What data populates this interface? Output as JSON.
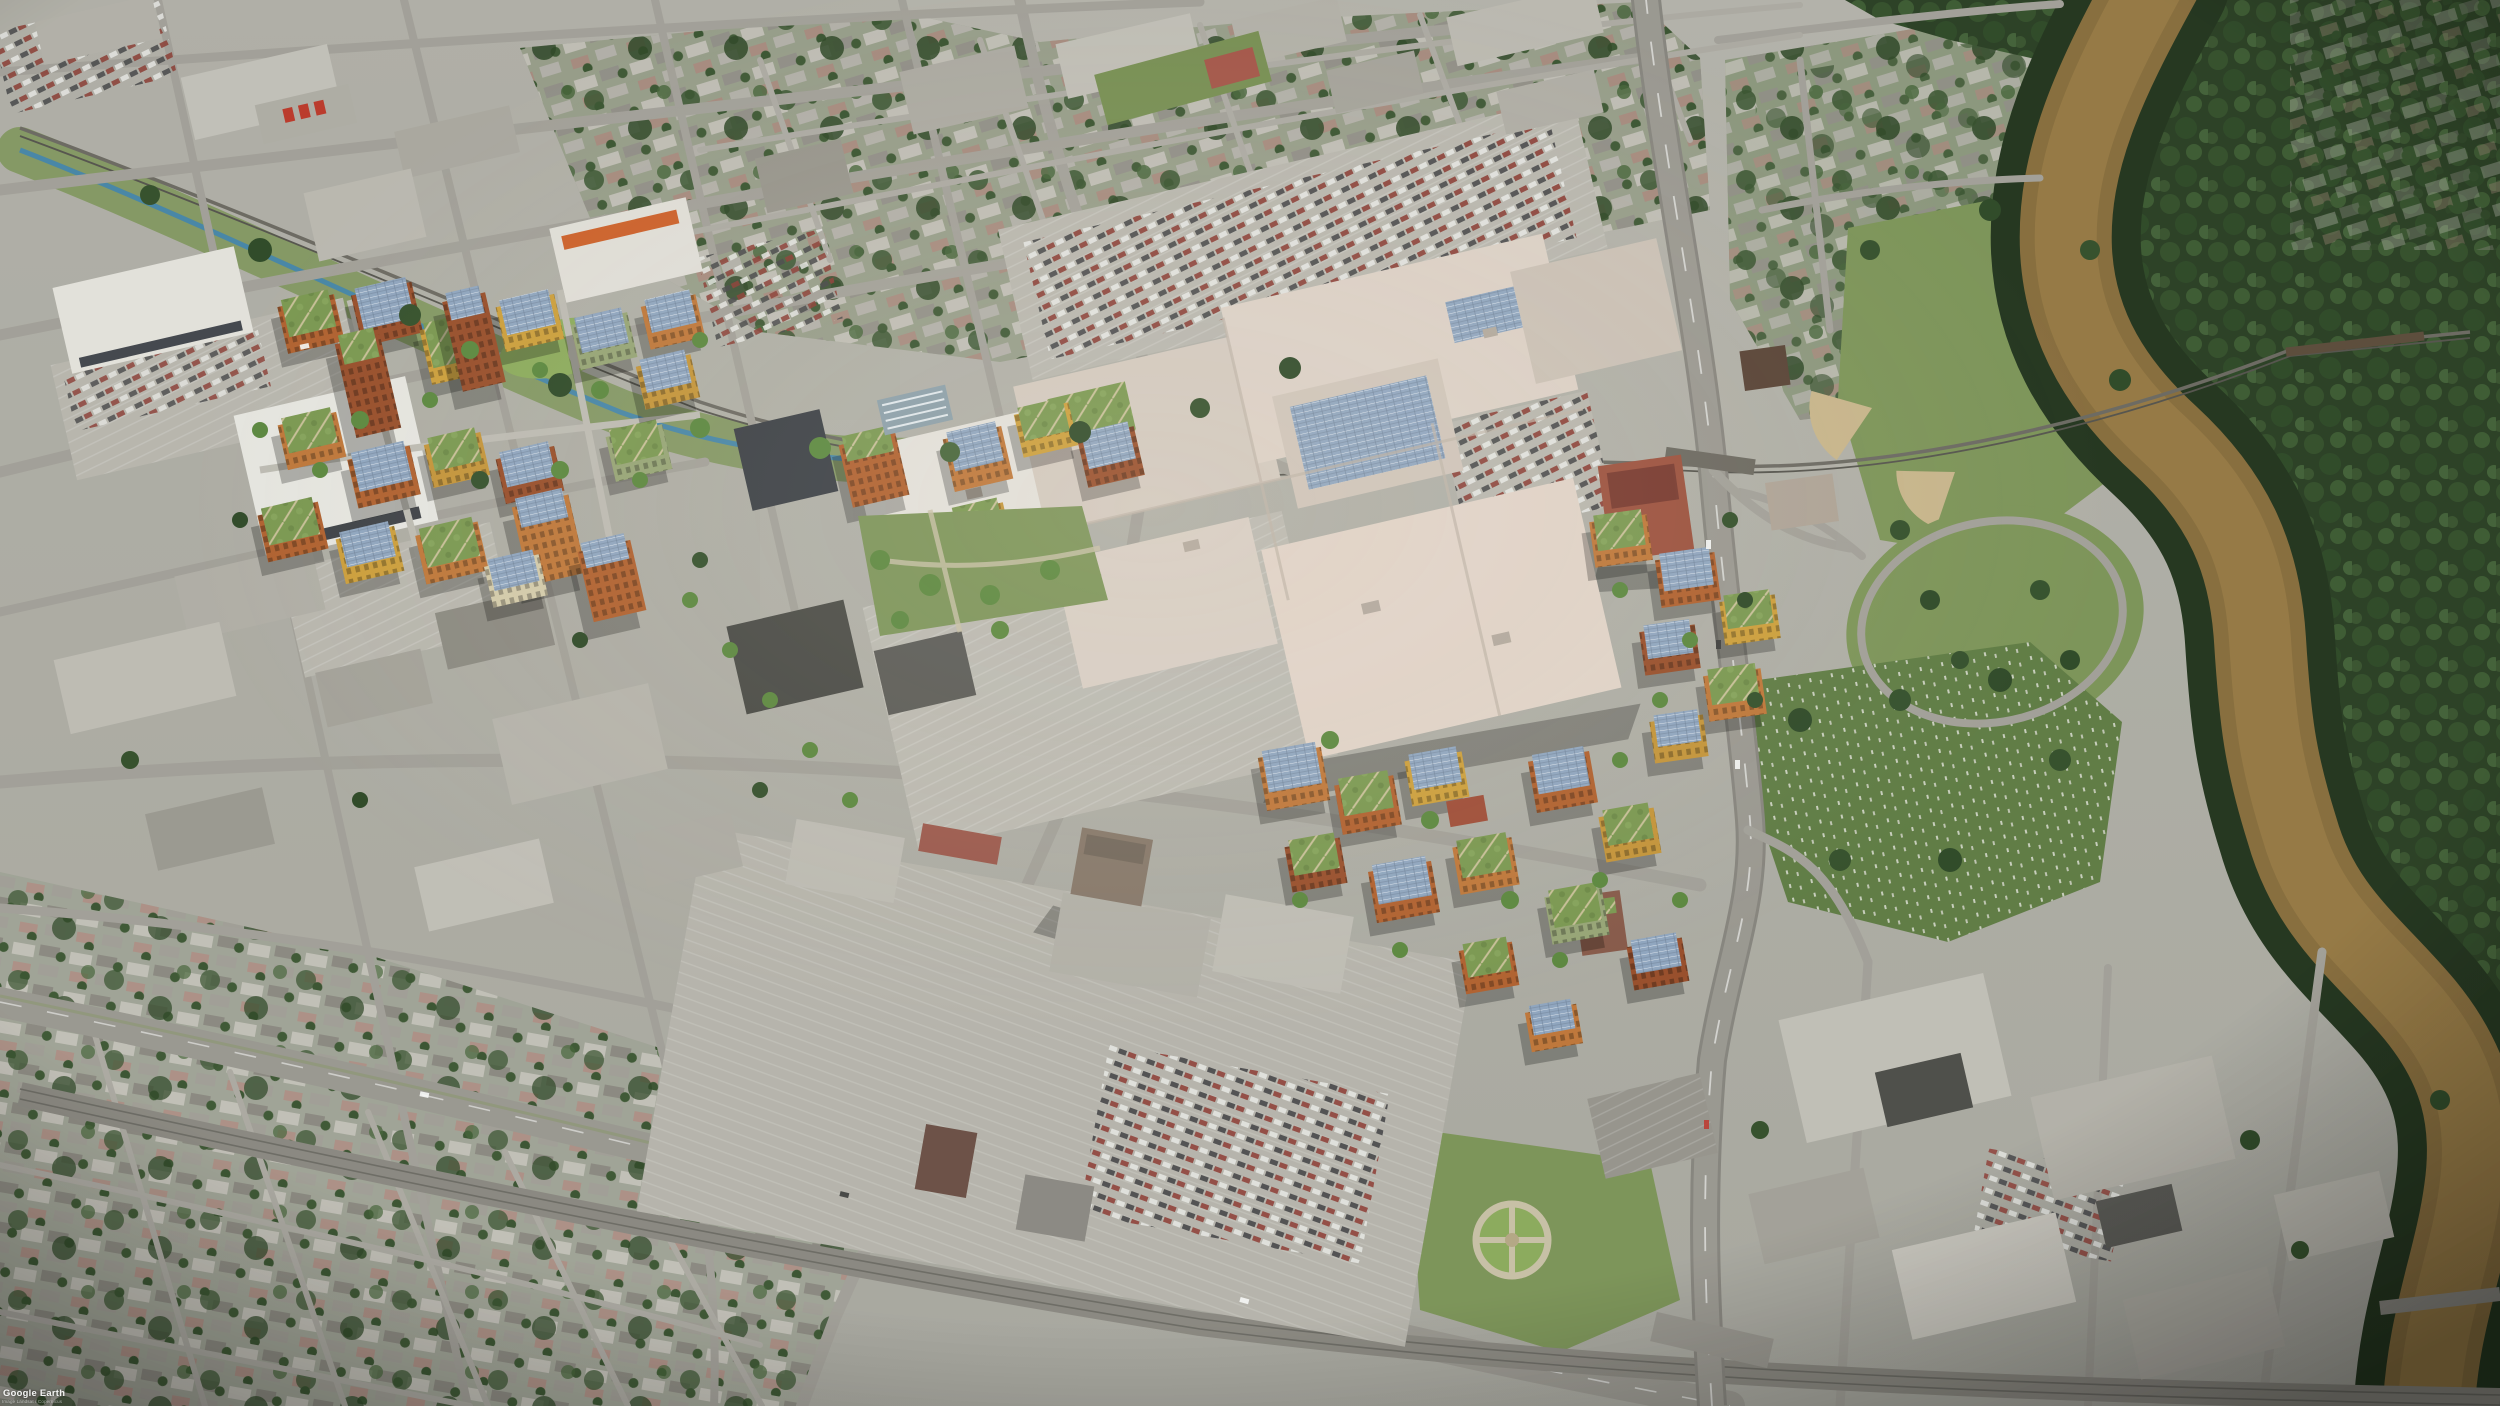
{
  "image": {
    "kind": "oblique aerial photograph with architectural rendering overlay",
    "watermark": {
      "brand": "Google Earth",
      "attribution": "Image Landsat / Copernicus"
    }
  },
  "palette": {
    "ground": "#b4b2aa",
    "road": "#a6a39c",
    "road_major": "#9e9b94",
    "parking": "#bdbab2",
    "river": "#8b6f3e",
    "river_light": "#9a7c46",
    "forest": "#2b4024",
    "grass": "#7f975a",
    "lawn": "#617e45",
    "courtyard": "#8fae5e",
    "dev_orange": "#b5622f",
    "dev_rust": "#c4793a",
    "dev_brick": "#9c4f2b",
    "dev_yellow": "#d2a23c",
    "dev_cream": "#d9cfae",
    "green_roof": "#7d9b52",
    "solar_panel": "#93a9c4",
    "mall_roof": "#ddcfc5",
    "mall_pink": "#e7d8cd",
    "white_roof": "#e9e7e1",
    "creek": "#4186b3",
    "diamond_sand": "#cdb98e",
    "watermark": "#ffffff"
  }
}
